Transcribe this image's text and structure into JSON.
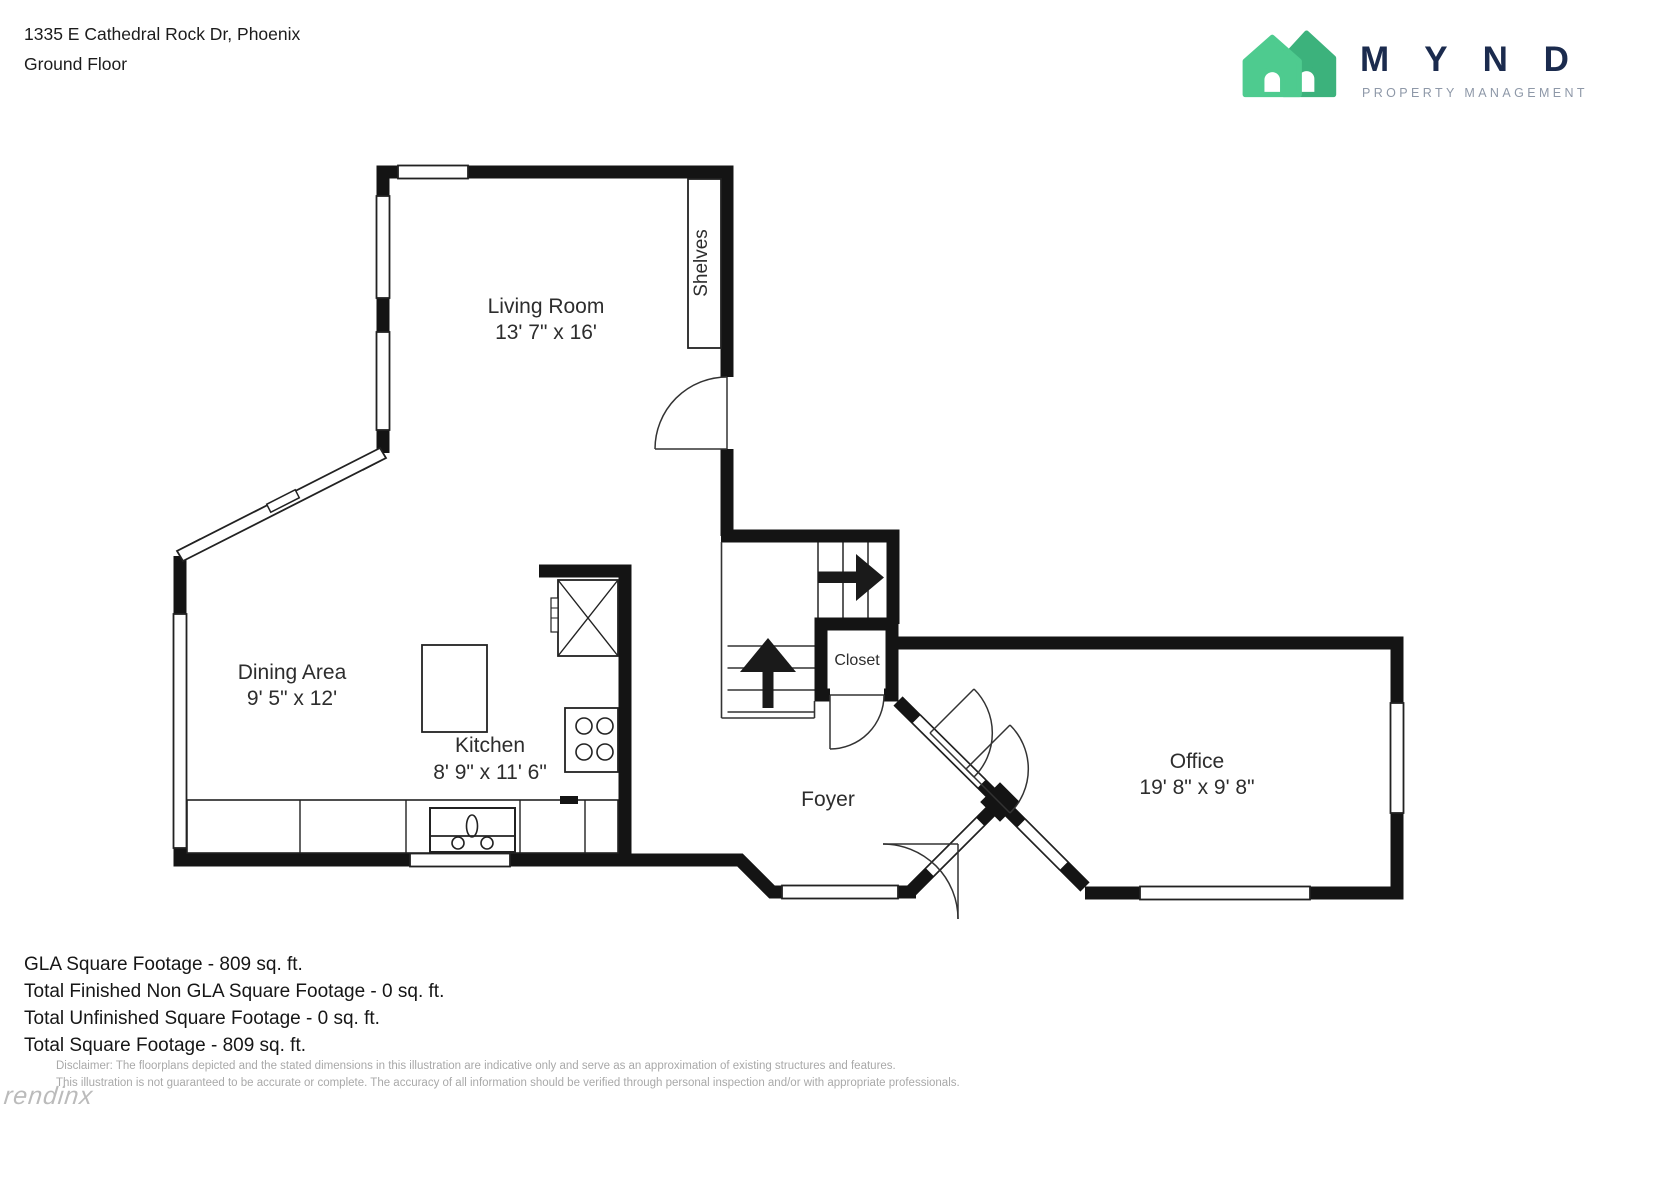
{
  "header": {
    "address": "1335 E Cathedral Rock Dr, Phoenix",
    "floor": "Ground Floor"
  },
  "logo": {
    "brand": "M Y N D",
    "tagline": "PROPERTY MANAGEMENT",
    "colors": {
      "house_front": "#4ecb8f",
      "house_back": "#3cb27c",
      "wordmark_navy": "#1b2b4e",
      "tagline_gray": "#8e98a8"
    }
  },
  "plan": {
    "wall_color": "#141414",
    "rooms": {
      "living_room": {
        "name": "Living Room",
        "dims": "13' 7\" x 16'"
      },
      "dining_area": {
        "name": "Dining Area",
        "dims": "9' 5\" x 12'"
      },
      "kitchen": {
        "name": "Kitchen",
        "dims": "8' 9\" x 11' 6\""
      },
      "office": {
        "name": "Office",
        "dims": "19' 8\" x 9' 8\""
      },
      "foyer": {
        "name": "Foyer"
      },
      "closet": {
        "name": "Closet"
      },
      "shelves_label": "Shelves"
    }
  },
  "summary": {
    "gla": "GLA Square Footage - 809 sq. ft.",
    "finished_non_gla": "Total Finished Non GLA Square Footage - 0 sq. ft.",
    "unfinished": "Total Unfinished Square Footage - 0 sq. ft.",
    "total": "Total Square Footage - 809 sq. ft."
  },
  "disclaimer": {
    "line1": "Disclaimer: The floorplans depicted and the stated dimensions in this illustration are indicative only and serve as an approximation of existing structures and features.",
    "line2": "This illustration is not guaranteed to be accurate or complete. The accuracy of all information should be verified through personal inspection and/or with appropriate professionals."
  },
  "watermark": {
    "text": "rendinx"
  }
}
